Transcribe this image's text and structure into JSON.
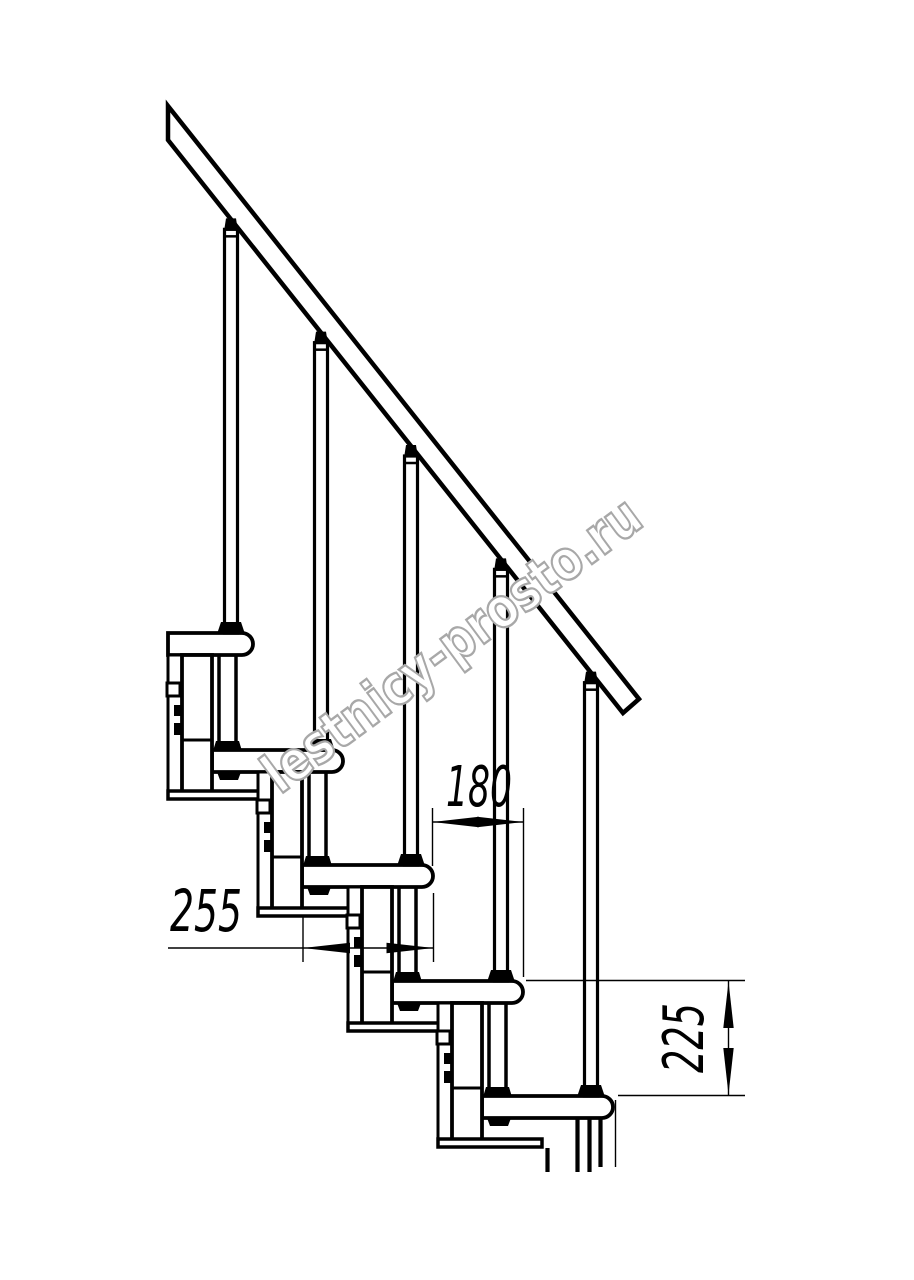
{
  "drawing": {
    "type": "staircase-side-view-technical-drawing",
    "background": "#ffffff",
    "line_color": "#000000"
  },
  "dimensions": {
    "tread_depth": {
      "label": "255",
      "unit": "mm",
      "meaning": "tread board depth"
    },
    "step_run": {
      "label": "180",
      "unit": "mm",
      "meaning": "horizontal run between step noses"
    },
    "step_rise": {
      "label": "225",
      "unit": "mm",
      "meaning": "riser height between treads"
    }
  },
  "watermark": {
    "text": "lestnicy-prosto.ru",
    "outline_color": "#a8a8a8",
    "fill_color": "#ffffff"
  },
  "staircase": {
    "steps_visible": 5,
    "balusters": 5,
    "has_handrail": true,
    "geometry_px": {
      "left_clip": 168,
      "rail": {
        "points": "168,106 639,699 623,713 168,140",
        "lower_x0": 168,
        "lower_y0": 140,
        "slope": 1.2593
      },
      "steps": [
        {
          "nose": 253,
          "top": 633
        },
        {
          "nose": 343,
          "top": 750
        },
        {
          "nose": 433,
          "top": 865
        },
        {
          "nose": 523,
          "top": 981
        },
        {
          "nose": 613,
          "top": 1096
        }
      ],
      "tread": {
        "length": 131,
        "thickness": 22,
        "nose_radius": 11
      },
      "baluster": {
        "offset_from_nose": 22,
        "width": 13
      },
      "module": {
        "outer_offset": 85,
        "outer_width": 14,
        "column_width": 30,
        "height": 143,
        "joint_offset": 85,
        "bar_offset": 136,
        "bar_height": 8,
        "bar_length": 104,
        "tab_offset": 28,
        "bolt_offsets": [
          50,
          68
        ],
        "rod_x_offsets": [
          34,
          17
        ]
      },
      "cut_lines": [
        [
          547.5,
          1148,
          1172
        ],
        [
          577.5,
          1118,
          1172
        ],
        [
          589.5,
          1118,
          1172
        ],
        [
          600.5,
          1118,
          1167
        ],
        [
          615.5,
          1100,
          1167
        ]
      ]
    }
  }
}
